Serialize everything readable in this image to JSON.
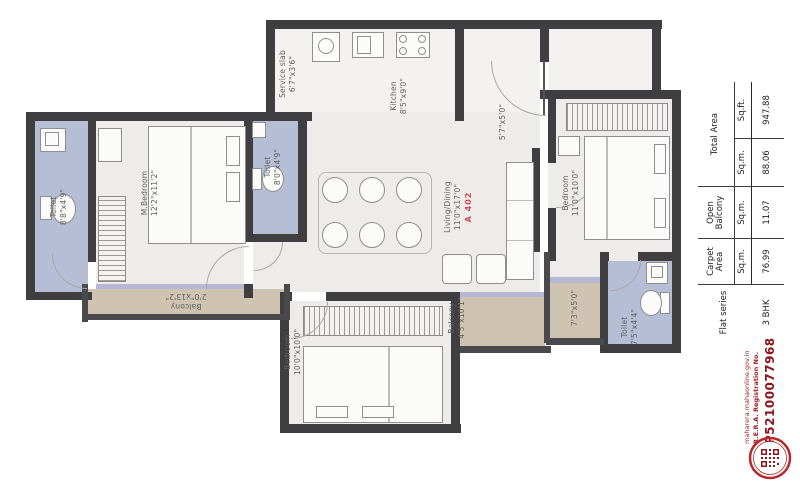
{
  "plan": {
    "flat_no": "A 402",
    "rooms": {
      "toilet_left": {
        "name": "Toilet",
        "dims": "8'8\"x4'9\""
      },
      "m_bedroom": {
        "name": "M.Bedroom",
        "dims": "12'2\"x11'2\""
      },
      "balcony_left": {
        "name": "Balcony",
        "dims": "2'0\"x13'2\""
      },
      "toilet_mid": {
        "name": "Toilet",
        "dims": "8'0\"x4'9\""
      },
      "service_slab": {
        "name": "Service slab",
        "dims": "6'7\"x3'6\""
      },
      "kitchen": {
        "name": "Kitchen",
        "dims": "8'5\"x9'0\""
      },
      "living_dining": {
        "name": "Living/Dining",
        "dims": "11'0\"x17'0\""
      },
      "passage": {
        "name": "",
        "dims": "5'7\"x5'0\""
      },
      "bedroom_right": {
        "name": "Bedroom",
        "dims": "11'0\"x10'0\""
      },
      "toilet_right": {
        "name": "Toilet",
        "dims": "7'5\"x4'4\""
      },
      "balcony_right": {
        "name": "",
        "dims": "7'3\"x5'0\""
      },
      "balcony_bottom": {
        "name": "Balcony",
        "dims": "4'5\"x10'1\""
      },
      "bedroom_bottom": {
        "name": "Bedroom",
        "dims": "10'0\"x10'0\""
      }
    }
  },
  "area_table": {
    "col_flat_series": "Flat series",
    "col_carpet": "Carpet Area",
    "col_open_balcony": "Open Balcony",
    "col_total": "Total Area",
    "unit_sqm_carpet": "Sq.m.",
    "unit_sqm_balcony": "Sq.m.",
    "unit_sqm_total": "Sq.m.",
    "unit_sqft_total": "Sq.ft.",
    "flat_type": "3 BHK",
    "carpet_sqm": "76.99",
    "open_balcony_sqm": "11.07",
    "total_sqm": "88.06",
    "total_sqft": "947.88"
  },
  "rera": {
    "website": "maharera.mahaonline.gov.in",
    "label": "R.E.R.A. Registration No.",
    "number": "P52100077968"
  },
  "colors": {
    "wall": "#3f3f41",
    "floor": "#edecea",
    "toilet_floor": "#b5bed4",
    "balcony_floor": "#cfc3b1",
    "flat_no_red": "#d4494e",
    "rera_red": "#a21d22"
  }
}
